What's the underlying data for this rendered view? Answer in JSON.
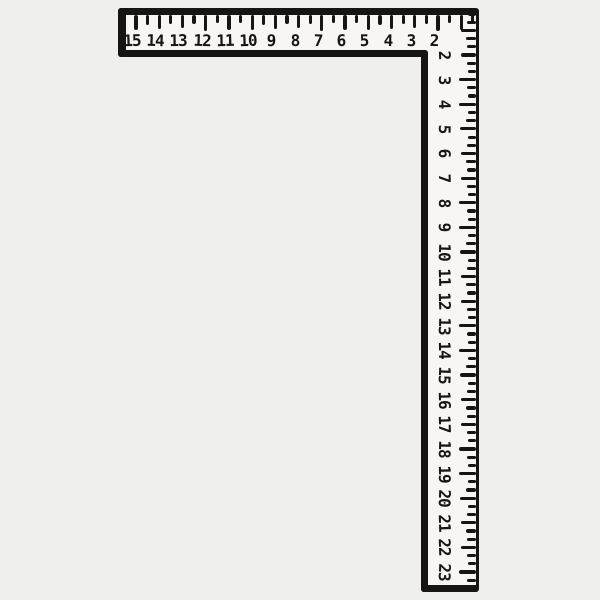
{
  "scene": {
    "background_color": "#efefed",
    "ink_color": "#171511",
    "face_color": "#f7f6f3"
  },
  "ruler": {
    "kind": "framing-square",
    "horizontal_scale": {
      "numbers": [
        "15",
        "14",
        "13",
        "12",
        "11",
        "10",
        "9",
        "8",
        "7",
        "6",
        "5",
        "4",
        "3",
        "2"
      ],
      "ticks_per_unit": 2
    },
    "vertical_scale": {
      "numbers": [
        "2",
        "3",
        "4",
        "5",
        "6",
        "7",
        "8",
        "9",
        "10",
        "11",
        "12",
        "13",
        "14",
        "15",
        "16",
        "17",
        "18",
        "19",
        "20",
        "21",
        "22",
        "23"
      ],
      "ticks_per_unit": 3
    }
  }
}
